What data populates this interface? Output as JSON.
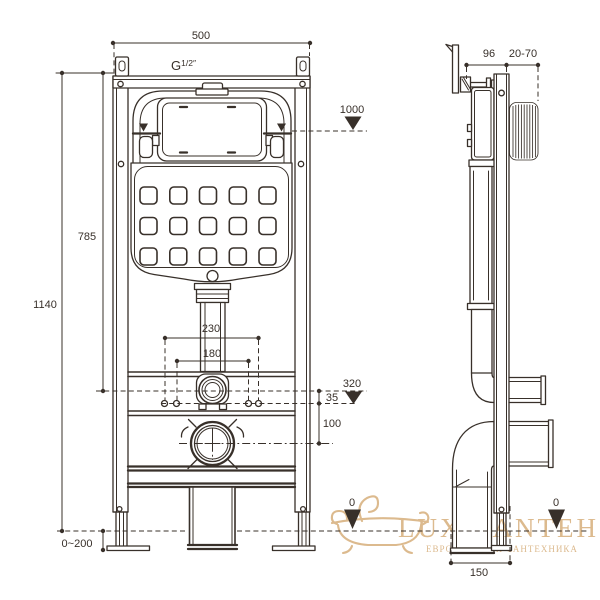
{
  "meta": {
    "drawing_type": "installation frame for wall-hung WC, dimensional drawing"
  },
  "colors": {
    "line": "#38302a",
    "watermark": "#dcba8e",
    "background": "#ffffff"
  },
  "front_view": {
    "width": "500",
    "thread_base": "G",
    "thread_sup": "1/2″",
    "level_1000": "1000",
    "height_overall": "1140",
    "height_785": "785",
    "spacing_230": "230",
    "spacing_180": "180",
    "level_320": "320",
    "offset_35": "35",
    "offset_100": "100",
    "floor_adjust": "0~200",
    "floor_zero": "0"
  },
  "side_view": {
    "depth_96": "96",
    "wall_range": "20-70",
    "floor_zero": "0",
    "base_150": "150"
  },
  "watermark": {
    "brand": "LUX-SANTEH",
    "tagline": "ЕВРОПЕЙСКАЯ САНТЕХНИКА"
  }
}
